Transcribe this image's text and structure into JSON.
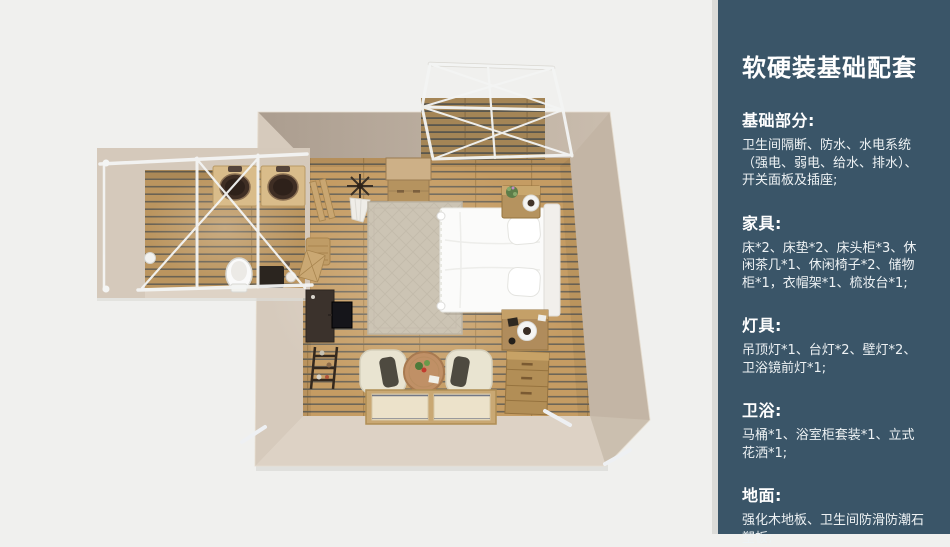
{
  "slide": {
    "background_color": "#f0f0ee",
    "panel_color": "#3a5568",
    "divider_color": "#dbdbd8",
    "title": "软硬装基础配套",
    "sections": [
      {
        "title": "基础部分:",
        "body": "卫生间隔断、防水、水电系统（强电、弱电、给水、排水）、开关面板及插座;"
      },
      {
        "title": "家具:",
        "body": "床*2、床垫*2、床头柜*3、休闲茶几*1、休闲椅子*2、储物柜*1，衣帽架*1、梳妆台*1;"
      },
      {
        "title": "灯具:",
        "body": "吊顶灯*1、台灯*2、壁灯*2、卫浴镜前灯*1;"
      },
      {
        "title": "卫浴:",
        "body": "马桶*1、浴室柜套装*1、立式花洒*1;"
      },
      {
        "title": "地面:",
        "body": "强化木地板、卫生间防滑防潮石塑板;"
      }
    ]
  },
  "floorplan": {
    "colors": {
      "wood_floor": "#c59c63",
      "deck_wood": "#ab8a57",
      "wall_beige": "#cfc3b4",
      "frame_white": "#f4f5f4",
      "bed_white": "#fbfbfa"
    }
  }
}
